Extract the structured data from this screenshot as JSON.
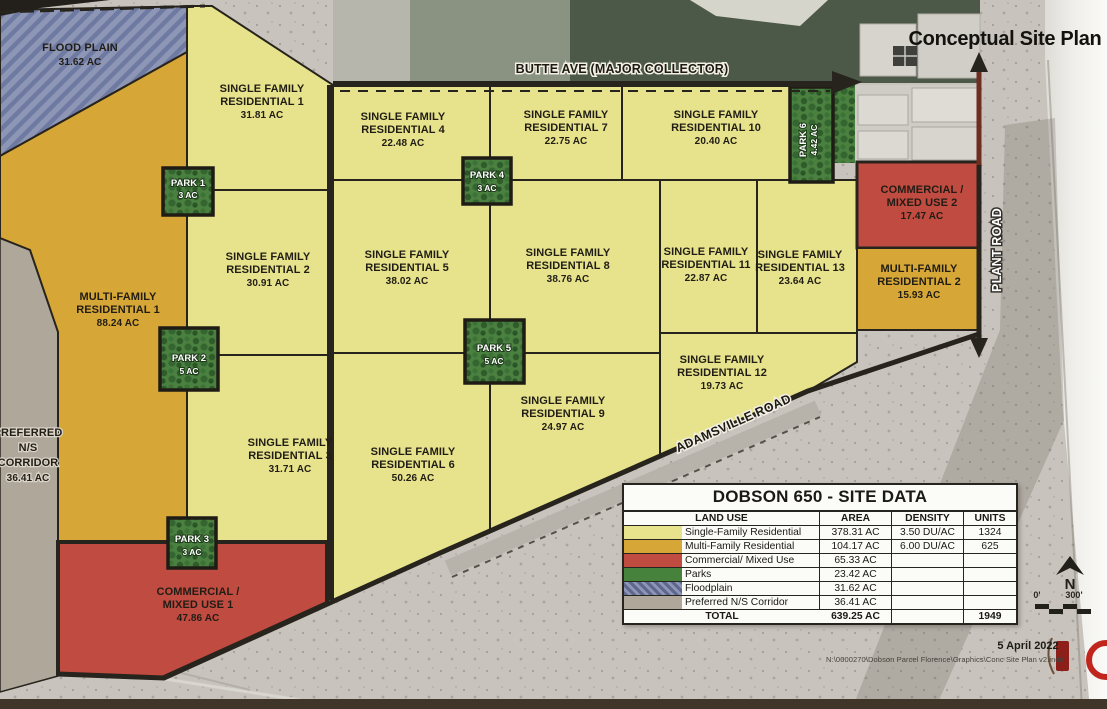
{
  "page_title": "Conceptual Site Plan",
  "roads": {
    "butte": "BUTTE AVE (MAJOR COLLECTOR)",
    "plant": "PLANT ROAD",
    "adamsville": "ADAMSVILLE ROAD"
  },
  "parcels": {
    "flood_plain": {
      "name": "FLOOD PLAIN",
      "area": "31.62 AC"
    },
    "preferred_corridor": {
      "l1": "PREFERRED",
      "l2": "N/S",
      "l3": "CORRIDOR",
      "area": "36.41 AC"
    },
    "mf1": {
      "l1": "MULTI-FAMILY",
      "l2": "RESIDENTIAL 1",
      "area": "88.24 AC"
    },
    "mf2": {
      "l1": "MULTI-FAMILY",
      "l2": "RESIDENTIAL 2",
      "area": "15.93 AC"
    },
    "com1": {
      "l1": "COMMERCIAL /",
      "l2": "MIXED USE 1",
      "area": "47.86 AC"
    },
    "com2": {
      "l1": "COMMERCIAL /",
      "l2": "MIXED USE 2",
      "area": "17.47 AC"
    },
    "sfr1": {
      "l1": "SINGLE FAMILY",
      "l2": "RESIDENTIAL 1",
      "area": "31.81 AC"
    },
    "sfr2": {
      "l1": "SINGLE FAMILY",
      "l2": "RESIDENTIAL 2",
      "area": "30.91 AC"
    },
    "sfr3": {
      "l1": "SINGLE FAMILY",
      "l2": "RESIDENTIAL 3",
      "area": "31.71 AC"
    },
    "sfr4": {
      "l1": "SINGLE FAMILY",
      "l2": "RESIDENTIAL 4",
      "area": "22.48 AC"
    },
    "sfr5": {
      "l1": "SINGLE FAMILY",
      "l2": "RESIDENTIAL 5",
      "area": "38.02 AC"
    },
    "sfr6": {
      "l1": "SINGLE FAMILY",
      "l2": "RESIDENTIAL 6",
      "area": "50.26 AC"
    },
    "sfr7": {
      "l1": "SINGLE FAMILY",
      "l2": "RESIDENTIAL 7",
      "area": "22.75 AC"
    },
    "sfr8": {
      "l1": "SINGLE FAMILY",
      "l2": "RESIDENTIAL 8",
      "area": "38.76 AC"
    },
    "sfr9": {
      "l1": "SINGLE FAMILY",
      "l2": "RESIDENTIAL 9",
      "area": "24.97 AC"
    },
    "sfr10": {
      "l1": "SINGLE FAMILY",
      "l2": "RESIDENTIAL 10",
      "area": "20.40 AC"
    },
    "sfr11": {
      "l1": "SINGLE FAMILY",
      "l2": "RESIDENTIAL 11",
      "area": "22.87 AC"
    },
    "sfr12": {
      "l1": "SINGLE FAMILY",
      "l2": "RESIDENTIAL 12",
      "area": "19.73 AC"
    },
    "sfr13": {
      "l1": "SINGLE FAMILY",
      "l2": "RESIDENTIAL 13",
      "area": "23.64 AC"
    }
  },
  "parks": {
    "p1": {
      "name": "PARK 1",
      "area": "3 AC"
    },
    "p2": {
      "name": "PARK 2",
      "area": "5 AC"
    },
    "p3": {
      "name": "PARK 3",
      "area": "3 AC"
    },
    "p4": {
      "name": "PARK 4",
      "area": "3 AC"
    },
    "p5": {
      "name": "PARK 5",
      "area": "5 AC"
    },
    "p6": {
      "name": "PARK 6",
      "area": "4.42 AC"
    }
  },
  "site_table": {
    "title": "DOBSON 650 - SITE DATA",
    "headers": {
      "land_use": "LAND USE",
      "area": "AREA",
      "density": "DENSITY",
      "units": "UNITS"
    },
    "rows": [
      {
        "land_use": "Single-Family Residential",
        "area": "378.31 AC",
        "density": "3.50 DU/AC",
        "units": "1324",
        "swatch": "#e7e38c"
      },
      {
        "land_use": "Multi-Family Residential",
        "area": "104.17 AC",
        "density": "6.00 DU/AC",
        "units": "625",
        "swatch": "#d6a737"
      },
      {
        "land_use": "Commercial/ Mixed Use",
        "area": "65.33 AC",
        "density": "",
        "units": "",
        "swatch": "#c04b41"
      },
      {
        "land_use": "Parks",
        "area": "23.42 AC",
        "density": "",
        "units": "",
        "swatch": "#47823c"
      },
      {
        "land_use": "Floodplain",
        "area": "31.62 AC",
        "density": "",
        "units": "",
        "swatch": "#8d96b5"
      },
      {
        "land_use": "Preferred N/S Corridor",
        "area": "36.41 AC",
        "density": "",
        "units": "",
        "swatch": "#b0a79b"
      }
    ],
    "total": {
      "label": "TOTAL",
      "area": "639.25 AC",
      "units": "1949"
    }
  },
  "compass": {
    "north": "N"
  },
  "scale_bar": {
    "start": "0'",
    "end": "300'"
  },
  "footer": {
    "date": "5 April 2022",
    "path": "N:\\0000270\\Dobson Parcel Florence\\Graphics\\Conc Site Plan v2.indd"
  },
  "colors": {
    "single_family": "#e7e38c",
    "multi_family": "#d6a737",
    "commercial": "#c04b41",
    "park": "#47823c",
    "floodplain": "#8d96b5",
    "corridor": "#b0a79b",
    "road": "#27231d"
  }
}
